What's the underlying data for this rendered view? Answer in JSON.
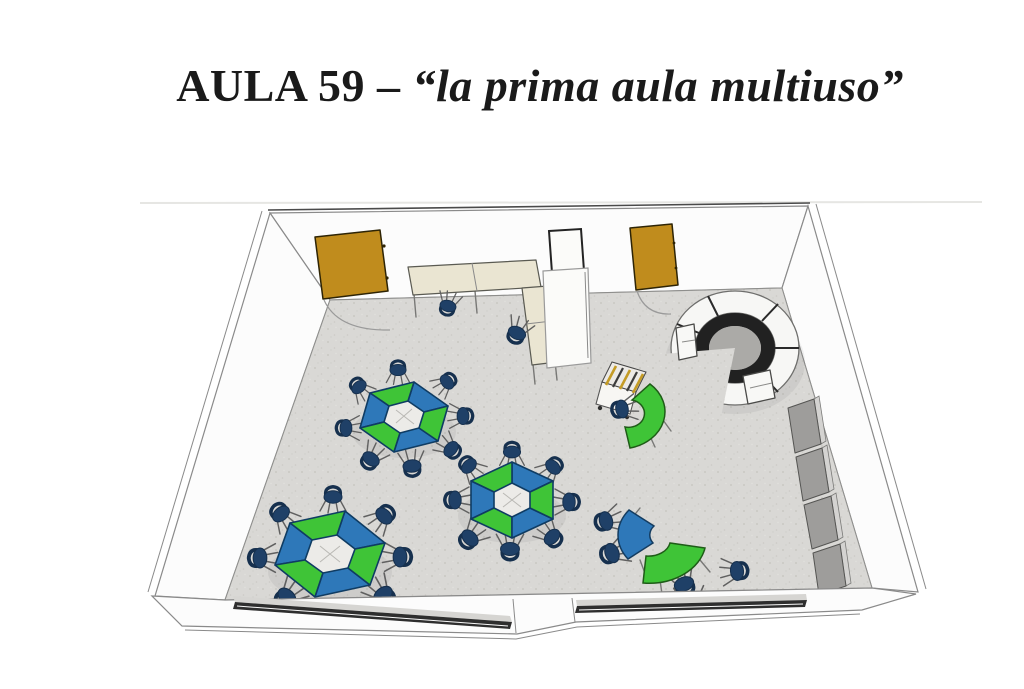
{
  "title": {
    "prefix": "AULA 59 – ",
    "quoted": "“la prima aula multiuso”"
  },
  "colors": {
    "title_ink": "#1a1a1a",
    "wall_fill": "#fcfcfc",
    "wall_line": "#8a8a8a",
    "edge_dark": "#4a4a4a",
    "floor_fill": "#d9d8d5",
    "floor_speck": "#c4c3be",
    "door_fill": "#c08c1d",
    "door_line": "#2e2405",
    "desk_fill": "#eae5d2",
    "desk_line": "#5a5a52",
    "hex_green": "#3fc437",
    "hex_blue": "#2e78b9",
    "hex_line": "#0f3c63",
    "hex_hole": "#ecebe8",
    "chair_fill": "#1f4067",
    "chair_back": "#16304e",
    "chair_leg": "#606060",
    "booth_fill": "#f7f7f5",
    "booth_dark": "#212121",
    "booth_mid": "#abaaa7",
    "cab_gray": "#9e9d9b",
    "cab_gray_lt": "#d4d3d1",
    "cart_stripe": "#c49b25",
    "cart_dark": "#3c3c3c",
    "window_dark": "#2e2e2e",
    "panel_line": "#232323"
  },
  "scene": {
    "type": "classroom-3d-render",
    "furniture_counts": {
      "doors": 2,
      "hexagonal_modular_tables": 3,
      "student_chairs": 31,
      "wall_desks": 3,
      "tall_cabinet": 1,
      "horseshoe_reading_booth": 1,
      "device_cart": 1,
      "curved_desks": 3,
      "gray_wall_cabinets": 4,
      "windows": 2
    }
  }
}
